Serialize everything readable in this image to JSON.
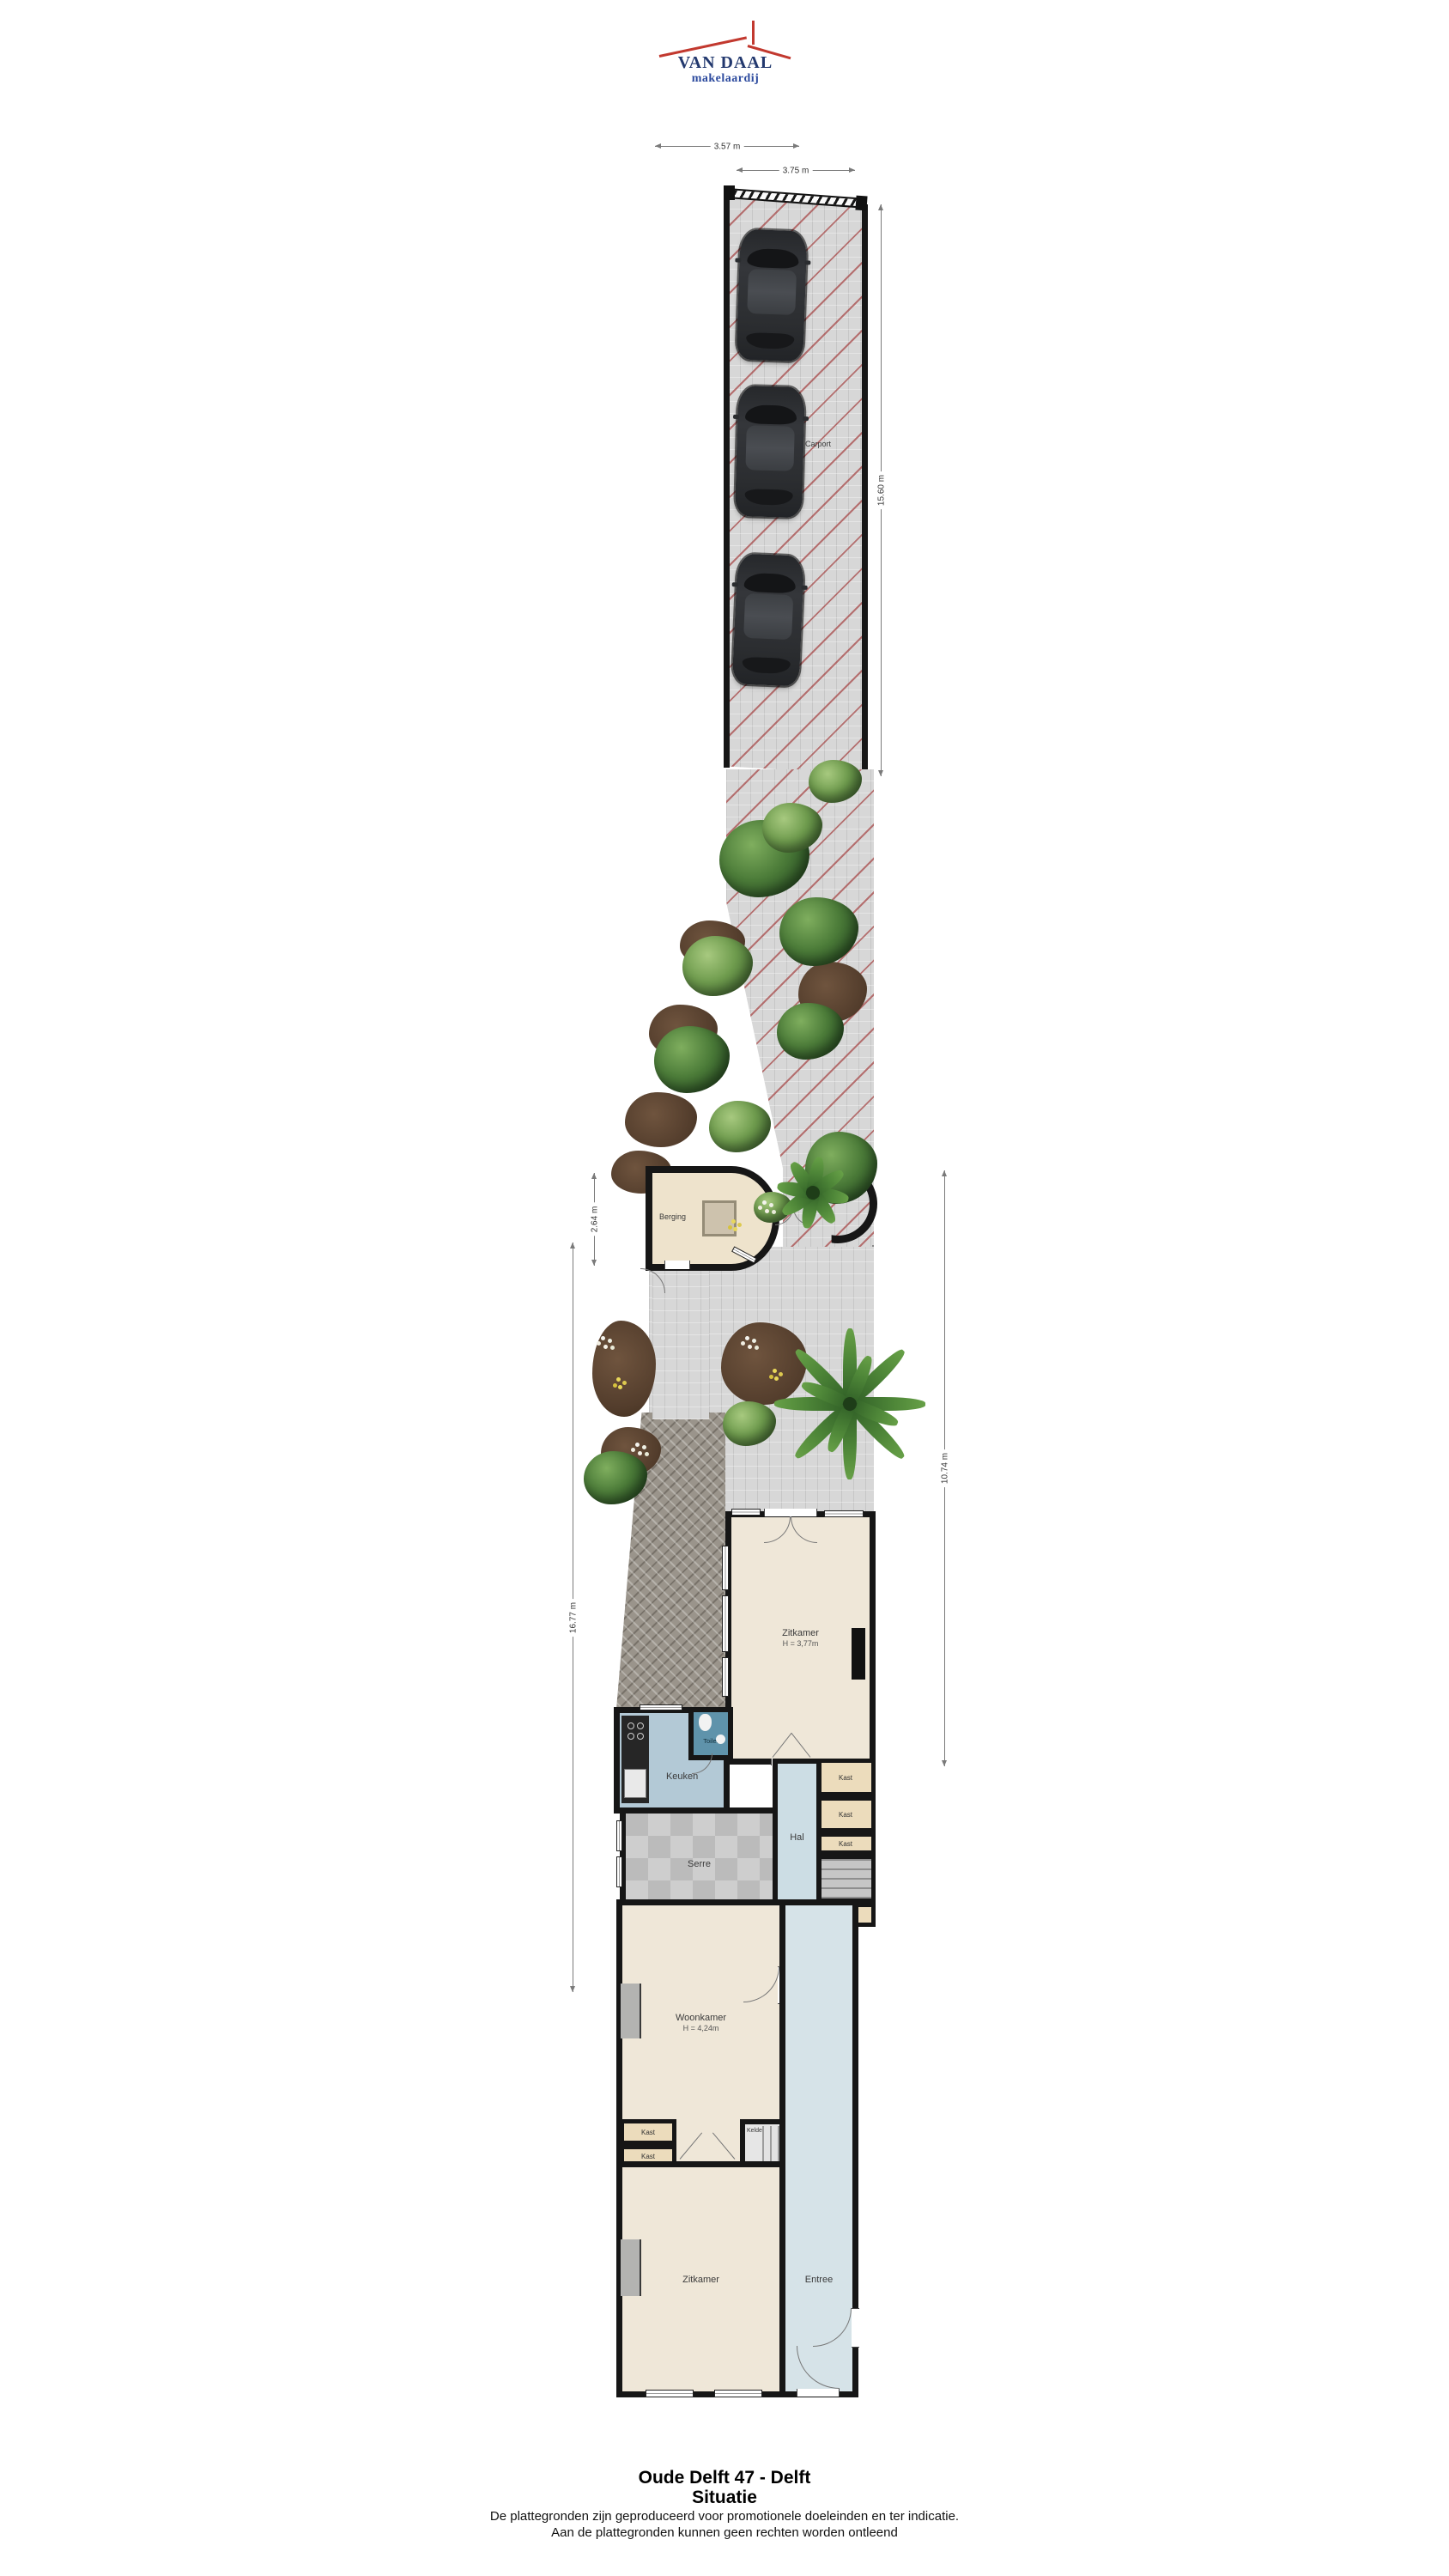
{
  "logo": {
    "name": "VAN DAAL",
    "tagline": "makelaardij"
  },
  "site": {
    "carport_label": "Carport",
    "berging_label": "Berging"
  },
  "dimensions": {
    "width_top": "3.57 m",
    "width_gate": "3.75 m",
    "carport_length": "15.60 m",
    "berging_depth": "2.64 m",
    "garden_length_left": "16.77 m",
    "garden_length_right": "10.74 m"
  },
  "rooms": {
    "zitkamer": {
      "label": "Zitkamer",
      "ceiling": "H = 3,77m"
    },
    "toilet": {
      "label": "Toilet"
    },
    "keuken": {
      "label": "Keuken"
    },
    "serre": {
      "label": "Serre"
    },
    "hal": {
      "label": "Hal"
    },
    "woonkamer": {
      "label": "Woonkamer",
      "ceiling": "H = 4,24m"
    },
    "kelder": {
      "label": "Kelder"
    },
    "zitkamer_voor": {
      "label": "Zitkamer"
    },
    "entree": {
      "label": "Entree"
    }
  },
  "closets": [
    "Kast",
    "Kast",
    "Kast",
    "Kast",
    "Kast",
    "Kast"
  ],
  "footer": {
    "address": "Oude Delft 47 - Delft",
    "plan_type": "Situatie",
    "disclaimer1": "De plattegronden zijn geproduceerd voor promotionele doeleinden en ter indicatie.",
    "disclaimer2": "Aan de plattegronden kunnen geen rechten worden ontleend"
  }
}
